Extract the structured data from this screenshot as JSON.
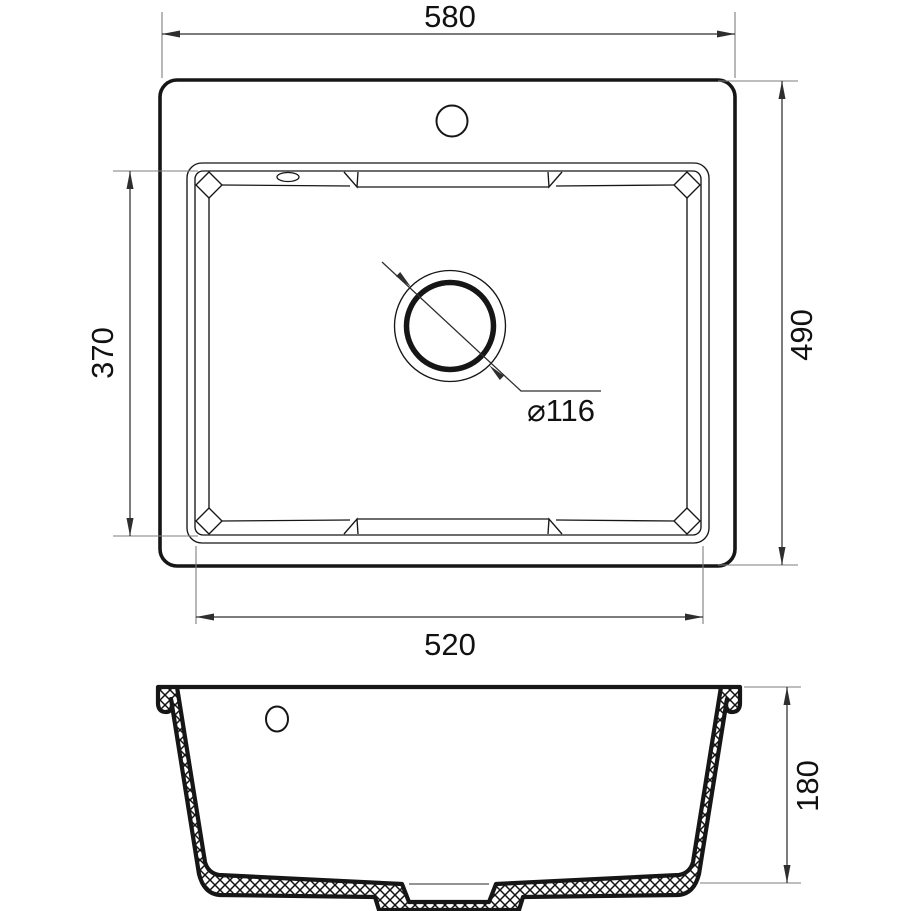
{
  "drawing": {
    "type": "sink-technical-drawing",
    "background": "#ffffff",
    "line_color": "#161616",
    "thin_line_color": "#1d1d1d",
    "dim_line_color": "#2e2e2e",
    "ext_line_color": "#7d7d7d",
    "text_color": "#111111",
    "dimensions": {
      "overall_width": "580",
      "overall_depth": "490",
      "bowl_depth": "370",
      "bowl_width": "520",
      "drain_diameter": "⌀116",
      "section_height": "180"
    }
  }
}
